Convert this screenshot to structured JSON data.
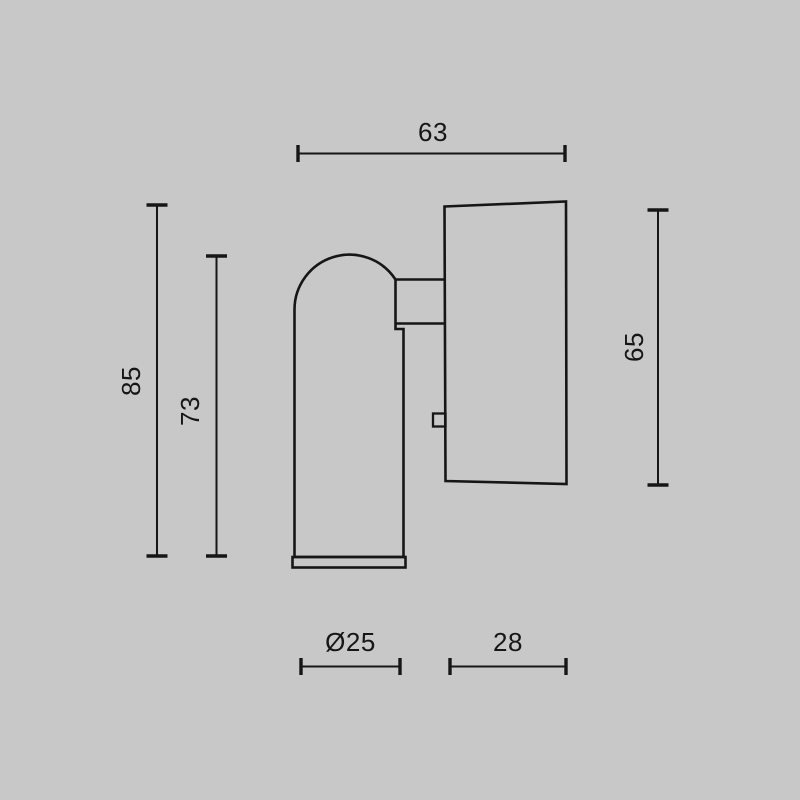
{
  "colors": {
    "background": "#c8c8c8",
    "ink": "#161616"
  },
  "dimensions": {
    "width_overall": "63",
    "height_overall": "85",
    "height_head": "73",
    "height_base": "65",
    "head_diameter": "Ø25",
    "base_depth": "28"
  }
}
